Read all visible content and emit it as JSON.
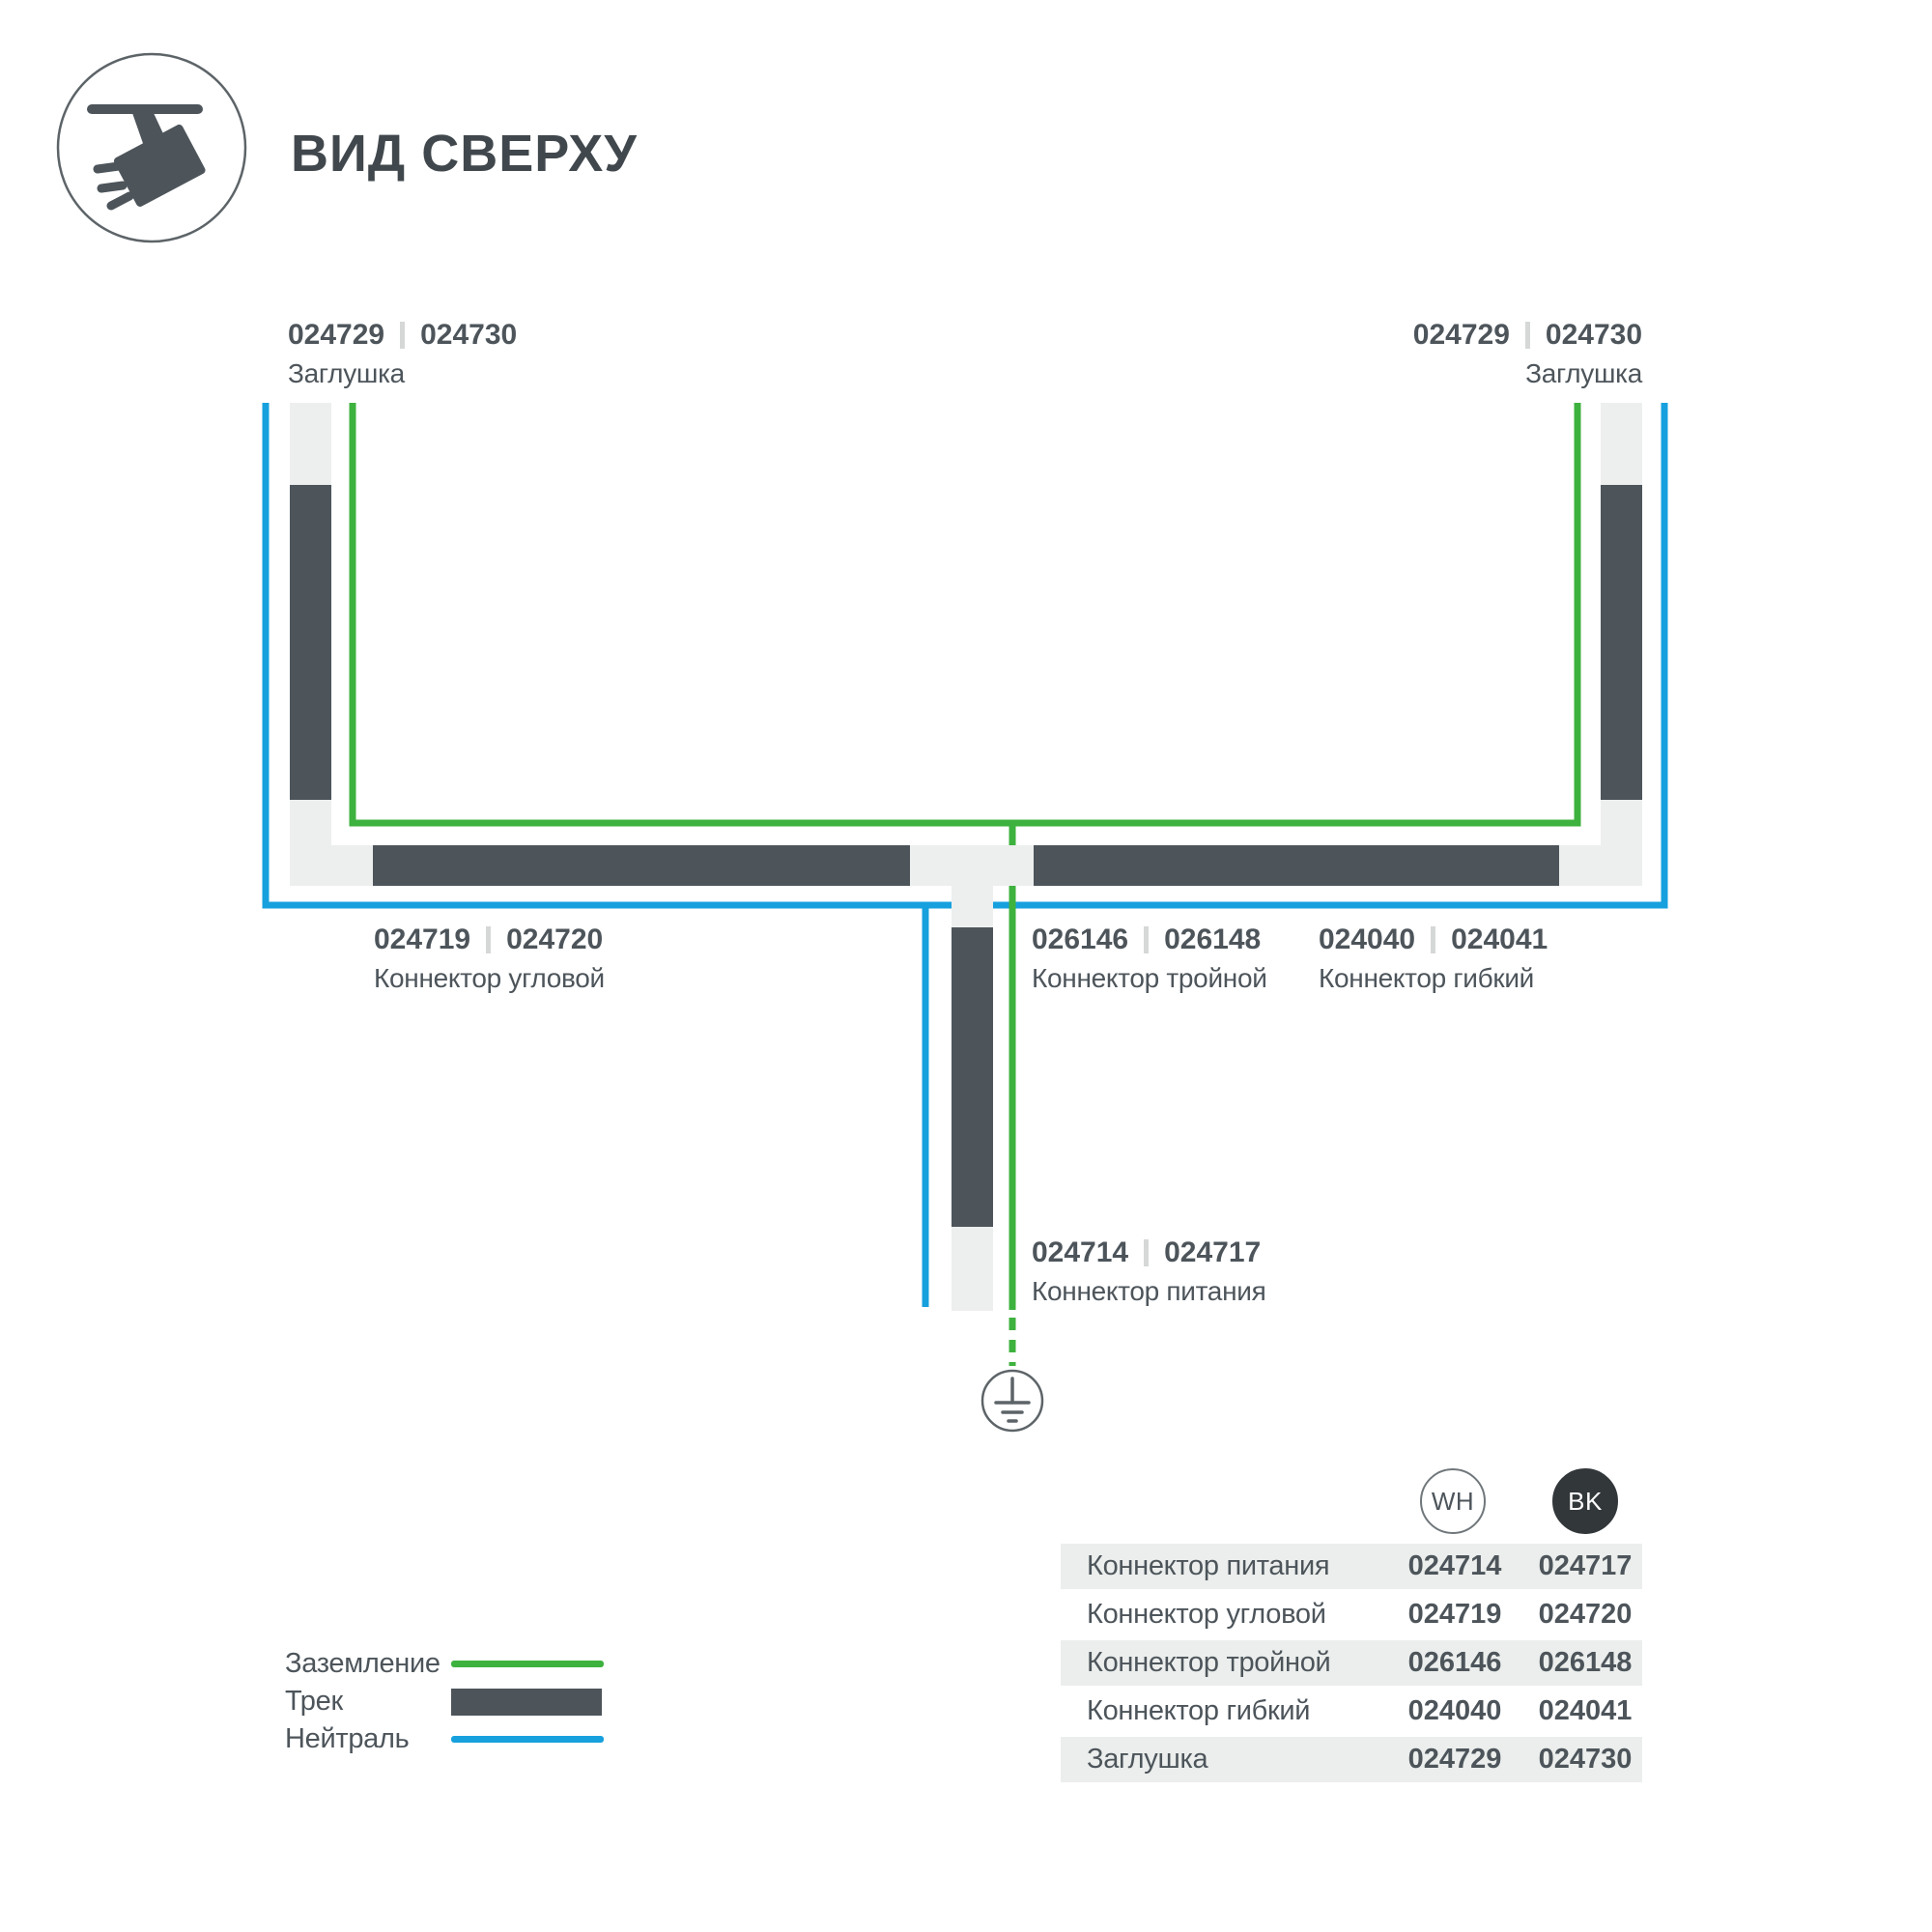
{
  "colors": {
    "track_dark": "#4d555b",
    "track_light": "#edefee",
    "wire_ground": "#3eb23e",
    "wire_neutral": "#17a0de",
    "text_dark": "#4d555b",
    "title_text": "#41484d",
    "table_row_bg": "#ebeeec",
    "bk_badge": "#32373a",
    "code_separator": "#d5d8d7",
    "icon_outline": "#5d6468",
    "badge_border": "#70777b"
  },
  "header": {
    "title": "ВИД СВЕРХУ",
    "icon": "track-spotlight"
  },
  "diagram": {
    "labels": {
      "endcap_left": {
        "wh": "024729",
        "bk": "024730",
        "name": "Заглушка"
      },
      "endcap_right": {
        "wh": "024729",
        "bk": "024730",
        "name": "Заглушка"
      },
      "corner": {
        "wh": "024719",
        "bk": "024720",
        "name": "Коннектор угловой"
      },
      "triple": {
        "wh": "026146",
        "bk": "026148",
        "name": "Коннектор тройной"
      },
      "flex": {
        "wh": "024040",
        "bk": "024041",
        "name": "Коннектор гибкий"
      },
      "power": {
        "wh": "024714",
        "bk": "024717",
        "name": "Коннектор питания"
      }
    },
    "legend": [
      {
        "label": "Заземление",
        "type": "ground-wire"
      },
      {
        "label": "Трек",
        "type": "track"
      },
      {
        "label": "Нейтраль",
        "type": "neutral-wire"
      }
    ]
  },
  "table": {
    "columns": {
      "wh": "WH",
      "bk": "BK"
    },
    "rows": [
      {
        "name": "Коннектор питания",
        "wh": "024714",
        "bk": "024717"
      },
      {
        "name": "Коннектор угловой",
        "wh": "024719",
        "bk": "024720"
      },
      {
        "name": "Коннектор тройной",
        "wh": "026146",
        "bk": "026148"
      },
      {
        "name": "Коннектор гибкий",
        "wh": "024040",
        "bk": "024041"
      },
      {
        "name": "Заглушка",
        "wh": "024729",
        "bk": "024730"
      }
    ]
  }
}
